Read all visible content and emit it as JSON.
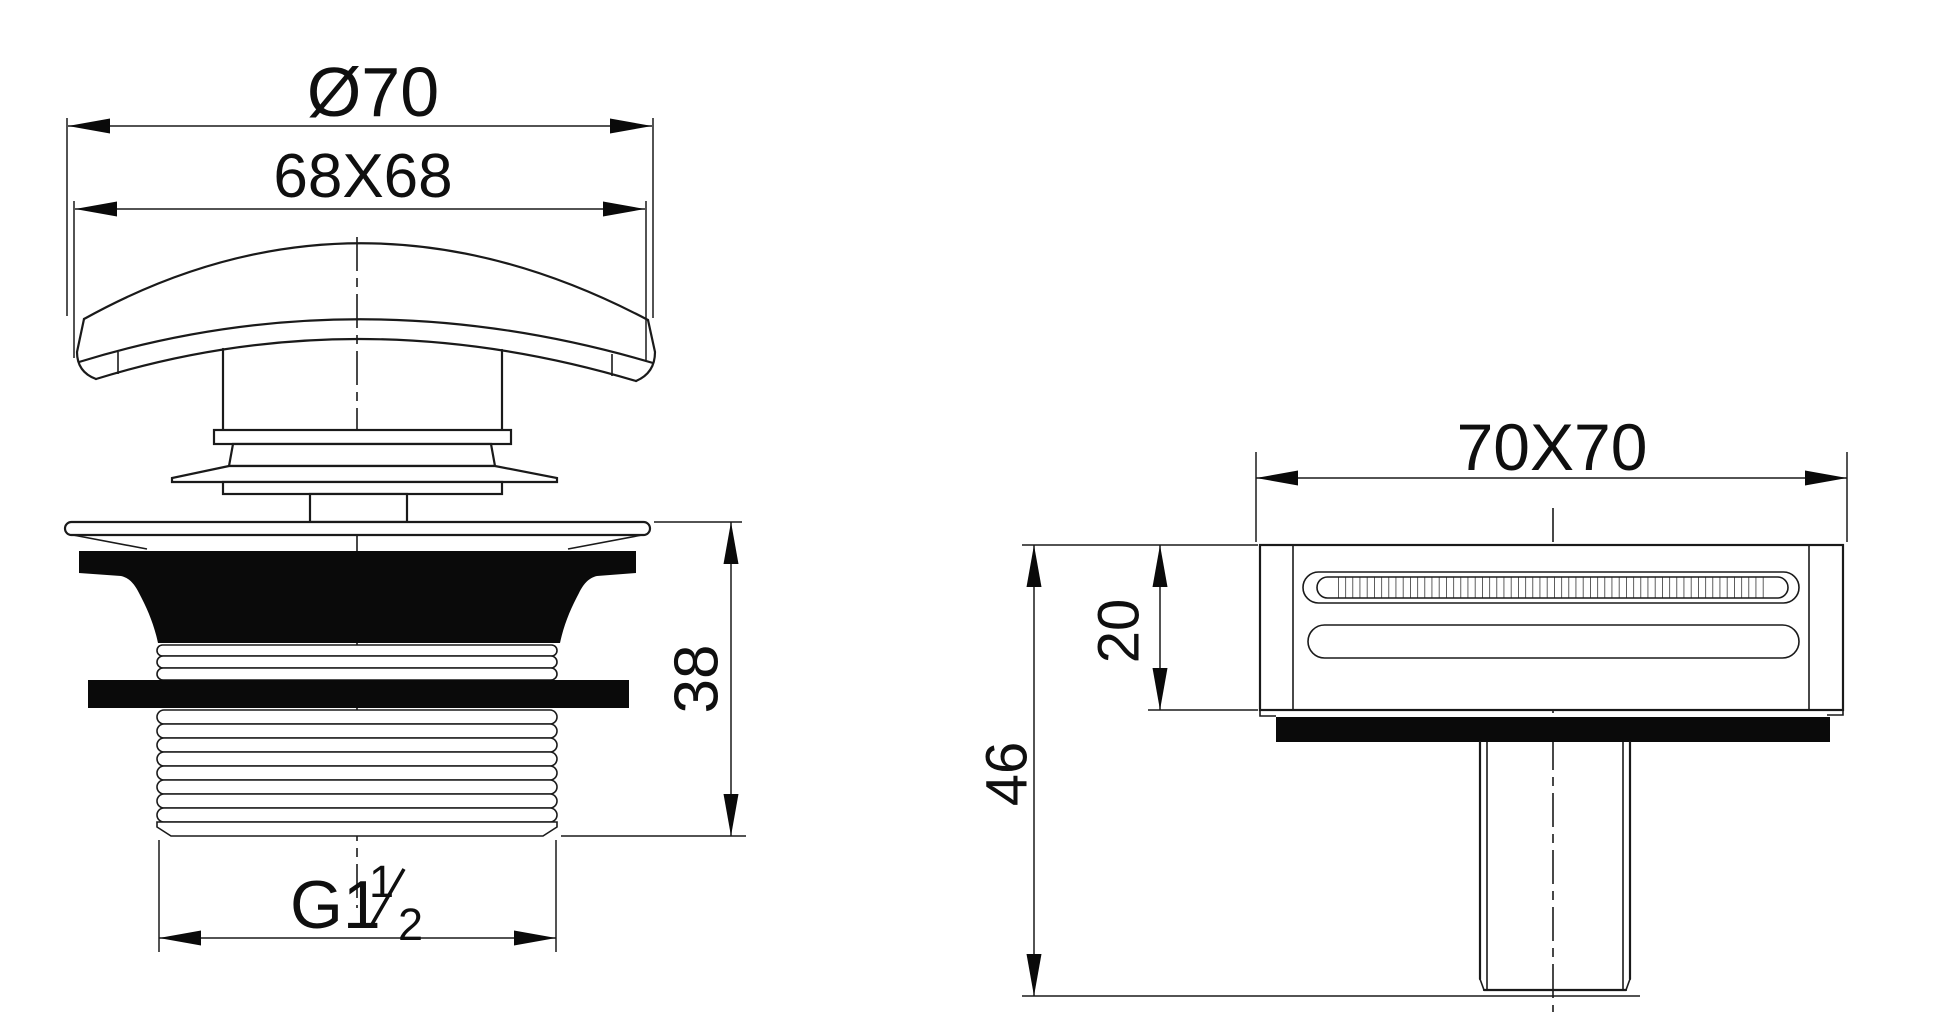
{
  "drawing": {
    "background": "#ffffff",
    "line_color": "#1a1a1a",
    "fill_color": "#0a0a0a",
    "front_view": {
      "dims": {
        "diameter": "Ø70",
        "cap_square": "68X68",
        "body_height": "38",
        "thread_size": "G1",
        "thread_frac_num": "1",
        "thread_frac_den": "2"
      }
    },
    "plan_view": {
      "dims": {
        "overall_square": "70X70",
        "grate_depth": "20",
        "overall_height": "46"
      }
    }
  }
}
